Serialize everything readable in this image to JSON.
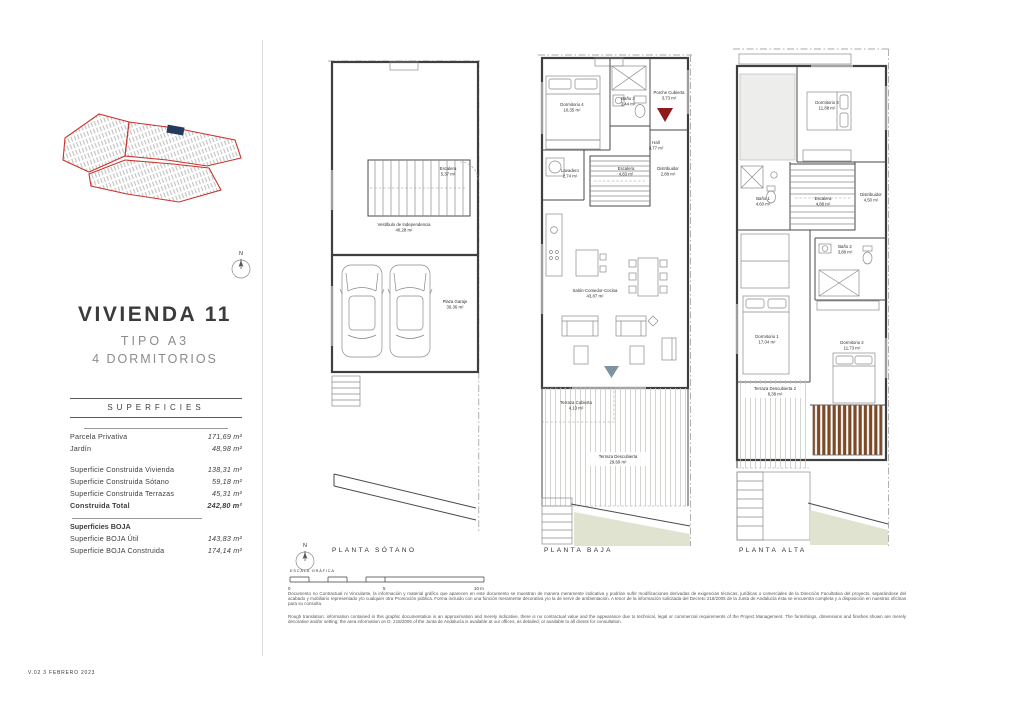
{
  "document": {
    "version_note": "V.02   3 FEBRERO 2023"
  },
  "left_panel": {
    "title": "VIVIENDA 11",
    "type_label": "TIPO A3",
    "bedrooms_label": "4 DORMITORIOS",
    "compass_letter": "N",
    "superficies": {
      "header": "SUPERFICIES",
      "parcela": {
        "label": "Parcela Privativa",
        "value": "171,69 m²"
      },
      "jardin": {
        "label": "Jardín",
        "value": "48,98 m²"
      },
      "construida_vivienda": {
        "label": "Superficie Construida Vivienda",
        "value": "138,31 m²"
      },
      "construida_sotano": {
        "label": "Superficie Construida Sótano",
        "value": "59,18 m²"
      },
      "construida_terrazas": {
        "label": "Superficie Construida Terrazas",
        "value": "45,31 m²"
      },
      "construida_total": {
        "label": "Construida Total",
        "value": "242,80 m²"
      },
      "boja_header": "Superficies BOJA",
      "boja_util": {
        "label": "Superficie BOJA Útil",
        "value": "143,83 m²"
      },
      "boja_construida": {
        "label": "Superficie BOJA Construida",
        "value": "174,14 m²"
      }
    }
  },
  "plans": {
    "sotano": {
      "label": "PLANTA SÓTANO",
      "rooms": {
        "escalera": {
          "name": "Escalera",
          "area": "5,37 m²"
        },
        "vestibulo": {
          "name": "Vestíbulo de Independencia",
          "area": "40,28 m²"
        },
        "garaje": {
          "name": "Plaza Garaje",
          "area": "30,36 m²"
        }
      }
    },
    "baja": {
      "label": "PLANTA BAJA",
      "rooms": {
        "dormitorio4": {
          "name": "Dormitorio 4",
          "area": "10,35 m²"
        },
        "bano3": {
          "name": "Baño 3",
          "area": "3,44 m²"
        },
        "porche": {
          "name": "Porche Cubierta",
          "area": "3,73 m²"
        },
        "hall": {
          "name": "Hall",
          "area": "3,77 m²"
        },
        "lavadero": {
          "name": "Lavadero",
          "area": "2,74 m²"
        },
        "escalera": {
          "name": "Escalera",
          "area": "4,83 m²"
        },
        "distribuidor": {
          "name": "Distribuidor",
          "area": "2,88 m²"
        },
        "salon": {
          "name": "Salón-Comedor-Cocina",
          "area": "43,87 m²"
        },
        "terraza_cubierta": {
          "name": "Terraza Cubierta",
          "area": "4,13 m²"
        },
        "terraza_descubierta": {
          "name": "Terraza Descubierta",
          "area": "29,69 m²"
        }
      }
    },
    "alta": {
      "label": "PLANTA ALTA",
      "rooms": {
        "dormitorio3": {
          "name": "Dormitorio 3",
          "area": "11,88 m²"
        },
        "bano1": {
          "name": "Baño 1",
          "area": "4,60 m²"
        },
        "escalera": {
          "name": "Escalera",
          "area": "4,88 m²"
        },
        "distribuidor": {
          "name": "Distribuidor",
          "area": "4,50 m²"
        },
        "bano2": {
          "name": "Baño 2",
          "area": "3,88 m²"
        },
        "dormitorio1": {
          "name": "Dormitorio 1",
          "area": "17,04 m²"
        },
        "dormitorio2": {
          "name": "Dormitorio 2",
          "area": "11,73 m²"
        },
        "terraza2": {
          "name": "Terraza Descubierta 2",
          "area": "8,38 m²"
        }
      }
    }
  },
  "footer": {
    "compass_letter": "N",
    "scale_label": "ESCALA GRÁFICA",
    "scale_ticks": {
      "zero": "0",
      "five": "5",
      "ten": "10 m"
    },
    "disclaimer_es": "Documento no Contractual ni Vinculante, la información y material gráfico que aparecen en este documento se muestran de manera meramente indicativa y podrían sufrir modificaciones derivadas de exigencias técnicas, jurídicas o comerciales de la Dirección Facultativa del proyecto, separándose del acabado y mobiliario representado y/o cualquier otra Promoción pública. Forma incluido con una función meramente decorativa y/o la de servir de ambientación. A tenor de la información solicitada del Decreto 218/2005 de la Junta de Andalucía ésta se encuentra completa y a disposición en nuestras oficinas para su consulta.",
    "disclaimer_en": "Rough translation: information contained in this graphic documentation is an approximation and merely indicative, there is no contractual value and the appearance due to technical, legal or commercial requirements of the Project Management. The furnishings, dimensions and finishes shown are merely decorative and/or setting; the area information on D. 218/2005 of the Junta de Andalucía is available at our offices, as detailed, or available to all clients for consultation."
  },
  "colors": {
    "entrance_marker_red": "#8e1b1b",
    "terrace_marker_gray": "#7d93a3",
    "pergola_brown": "#7c4a26",
    "site_plan_outline_red": "#c9342e",
    "site_plan_highlight_navy": "#233a5c",
    "ramp_sage_green": "#e0e3cf"
  }
}
